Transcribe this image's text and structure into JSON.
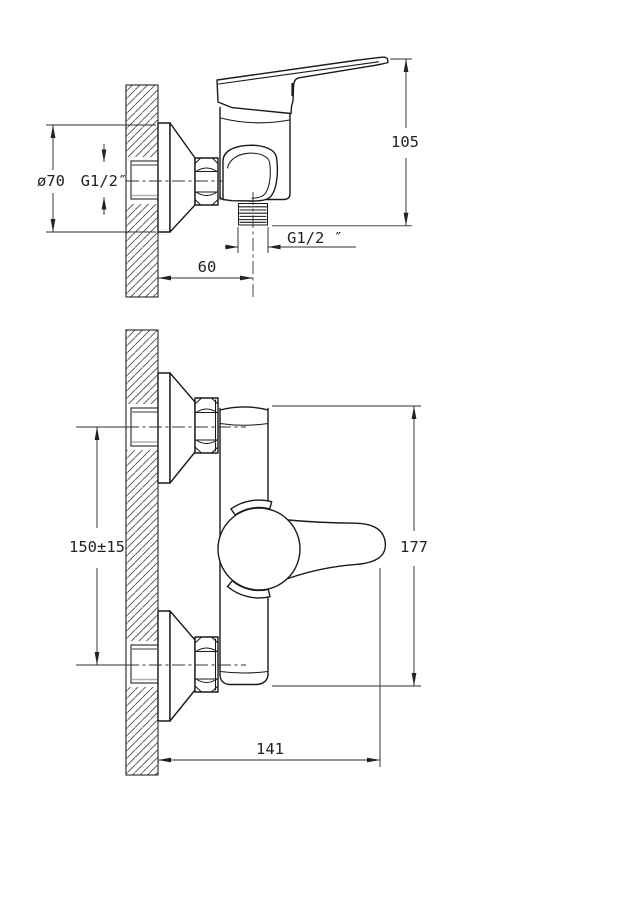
{
  "drawing": {
    "colors": {
      "background": "#ffffff",
      "object_lines": "#1a1a1a",
      "dimension_lines": "#2f2f2f",
      "text": "#222222"
    },
    "views": {
      "top": {
        "dims": {
          "flange_diameter": "ø70",
          "inlet_thread": "G1/2″",
          "height": "105",
          "outlet_thread": "G1/2 ″",
          "wall_to_outlet": "60"
        }
      },
      "front": {
        "dims": {
          "inlet_spacing": "150±15",
          "height": "177",
          "width": "141"
        }
      }
    }
  }
}
